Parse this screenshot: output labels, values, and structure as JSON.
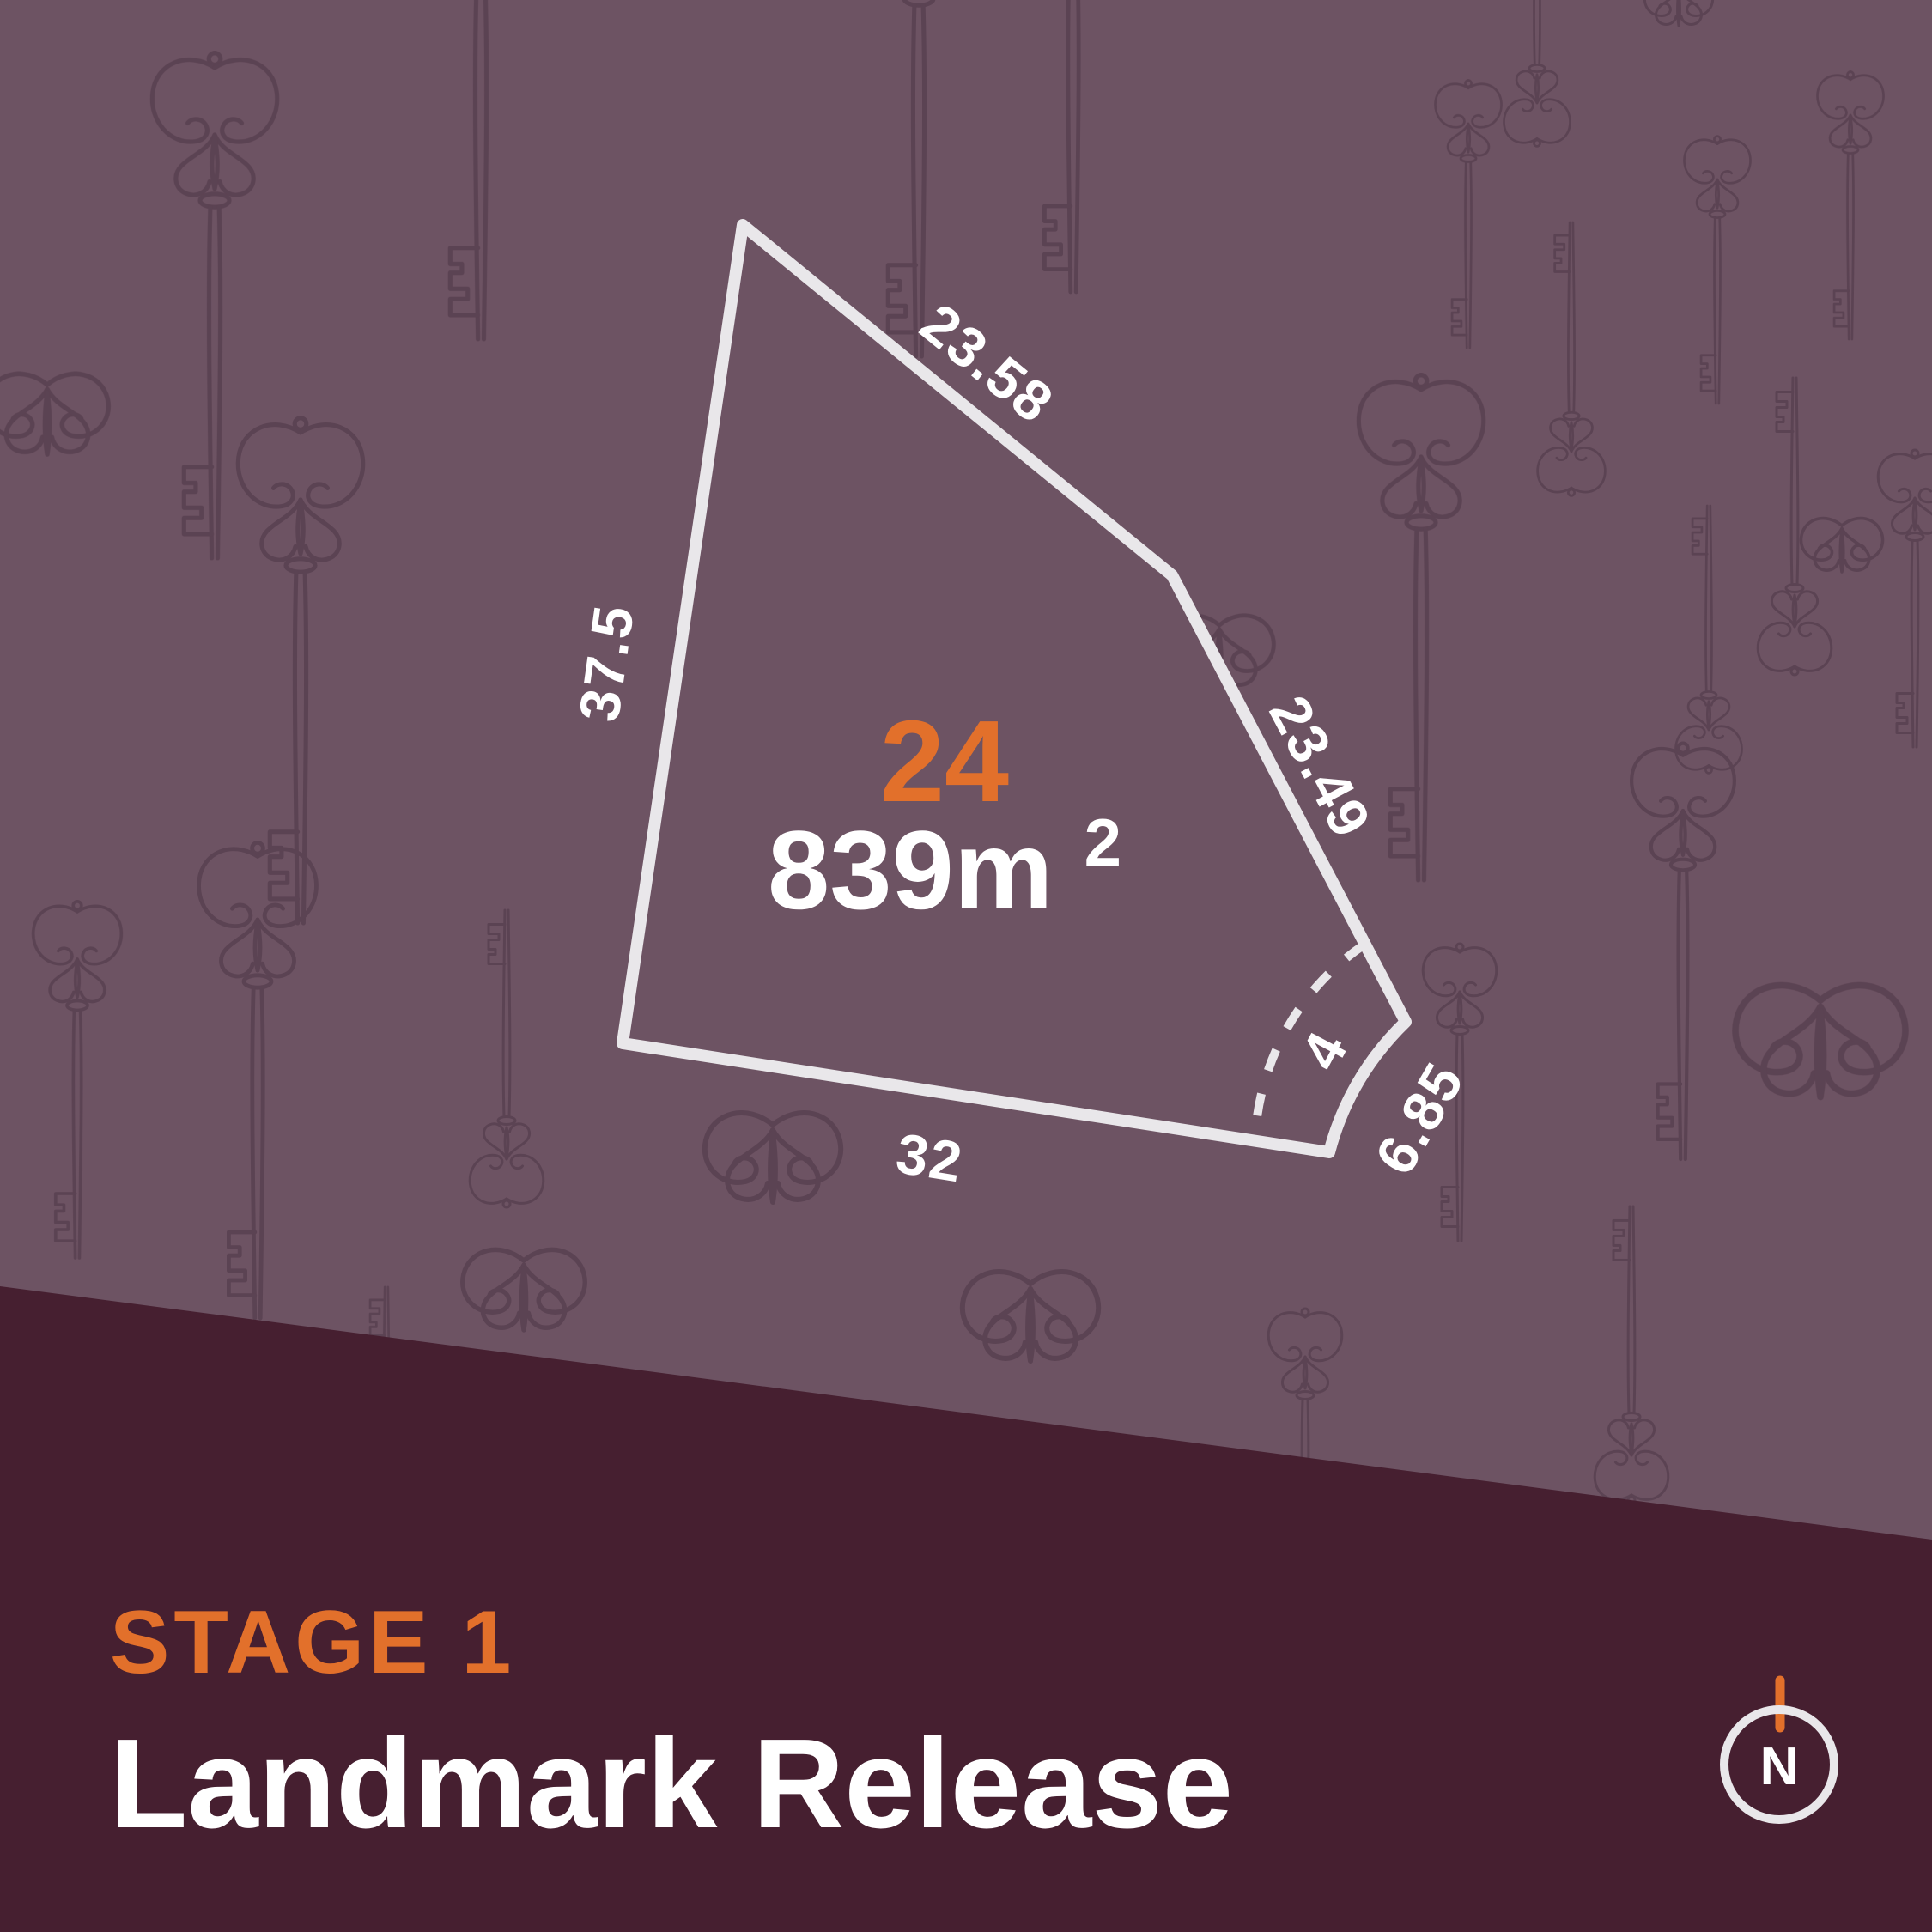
{
  "title": "Stage 1 Landmark Release lot plan",
  "lot": {
    "number": "24",
    "area_value": "839m",
    "area_superscript": "2",
    "dimensions": {
      "top_edge": "23.58",
      "right_edge": "23.49",
      "left_edge": "37.5",
      "bottom_edge": "32",
      "corner_arc": "4",
      "corner_edge": "6.85"
    }
  },
  "footer": {
    "stage_label": "STAGE 1",
    "release_title": "Landmark Release"
  },
  "compass": {
    "north_label": "N"
  },
  "icons": {
    "key_pattern": "vintage-skeleton-key-wallpaper",
    "compass": "north-compass-icon"
  },
  "colors": {
    "background_mauve": "#6D5363",
    "key_pattern": "#533B4B",
    "footer_band": "#461F30",
    "accent_orange": "#E2702B",
    "line_offwhite": "#E9E7EA",
    "text_white": "#FFFFFF"
  }
}
